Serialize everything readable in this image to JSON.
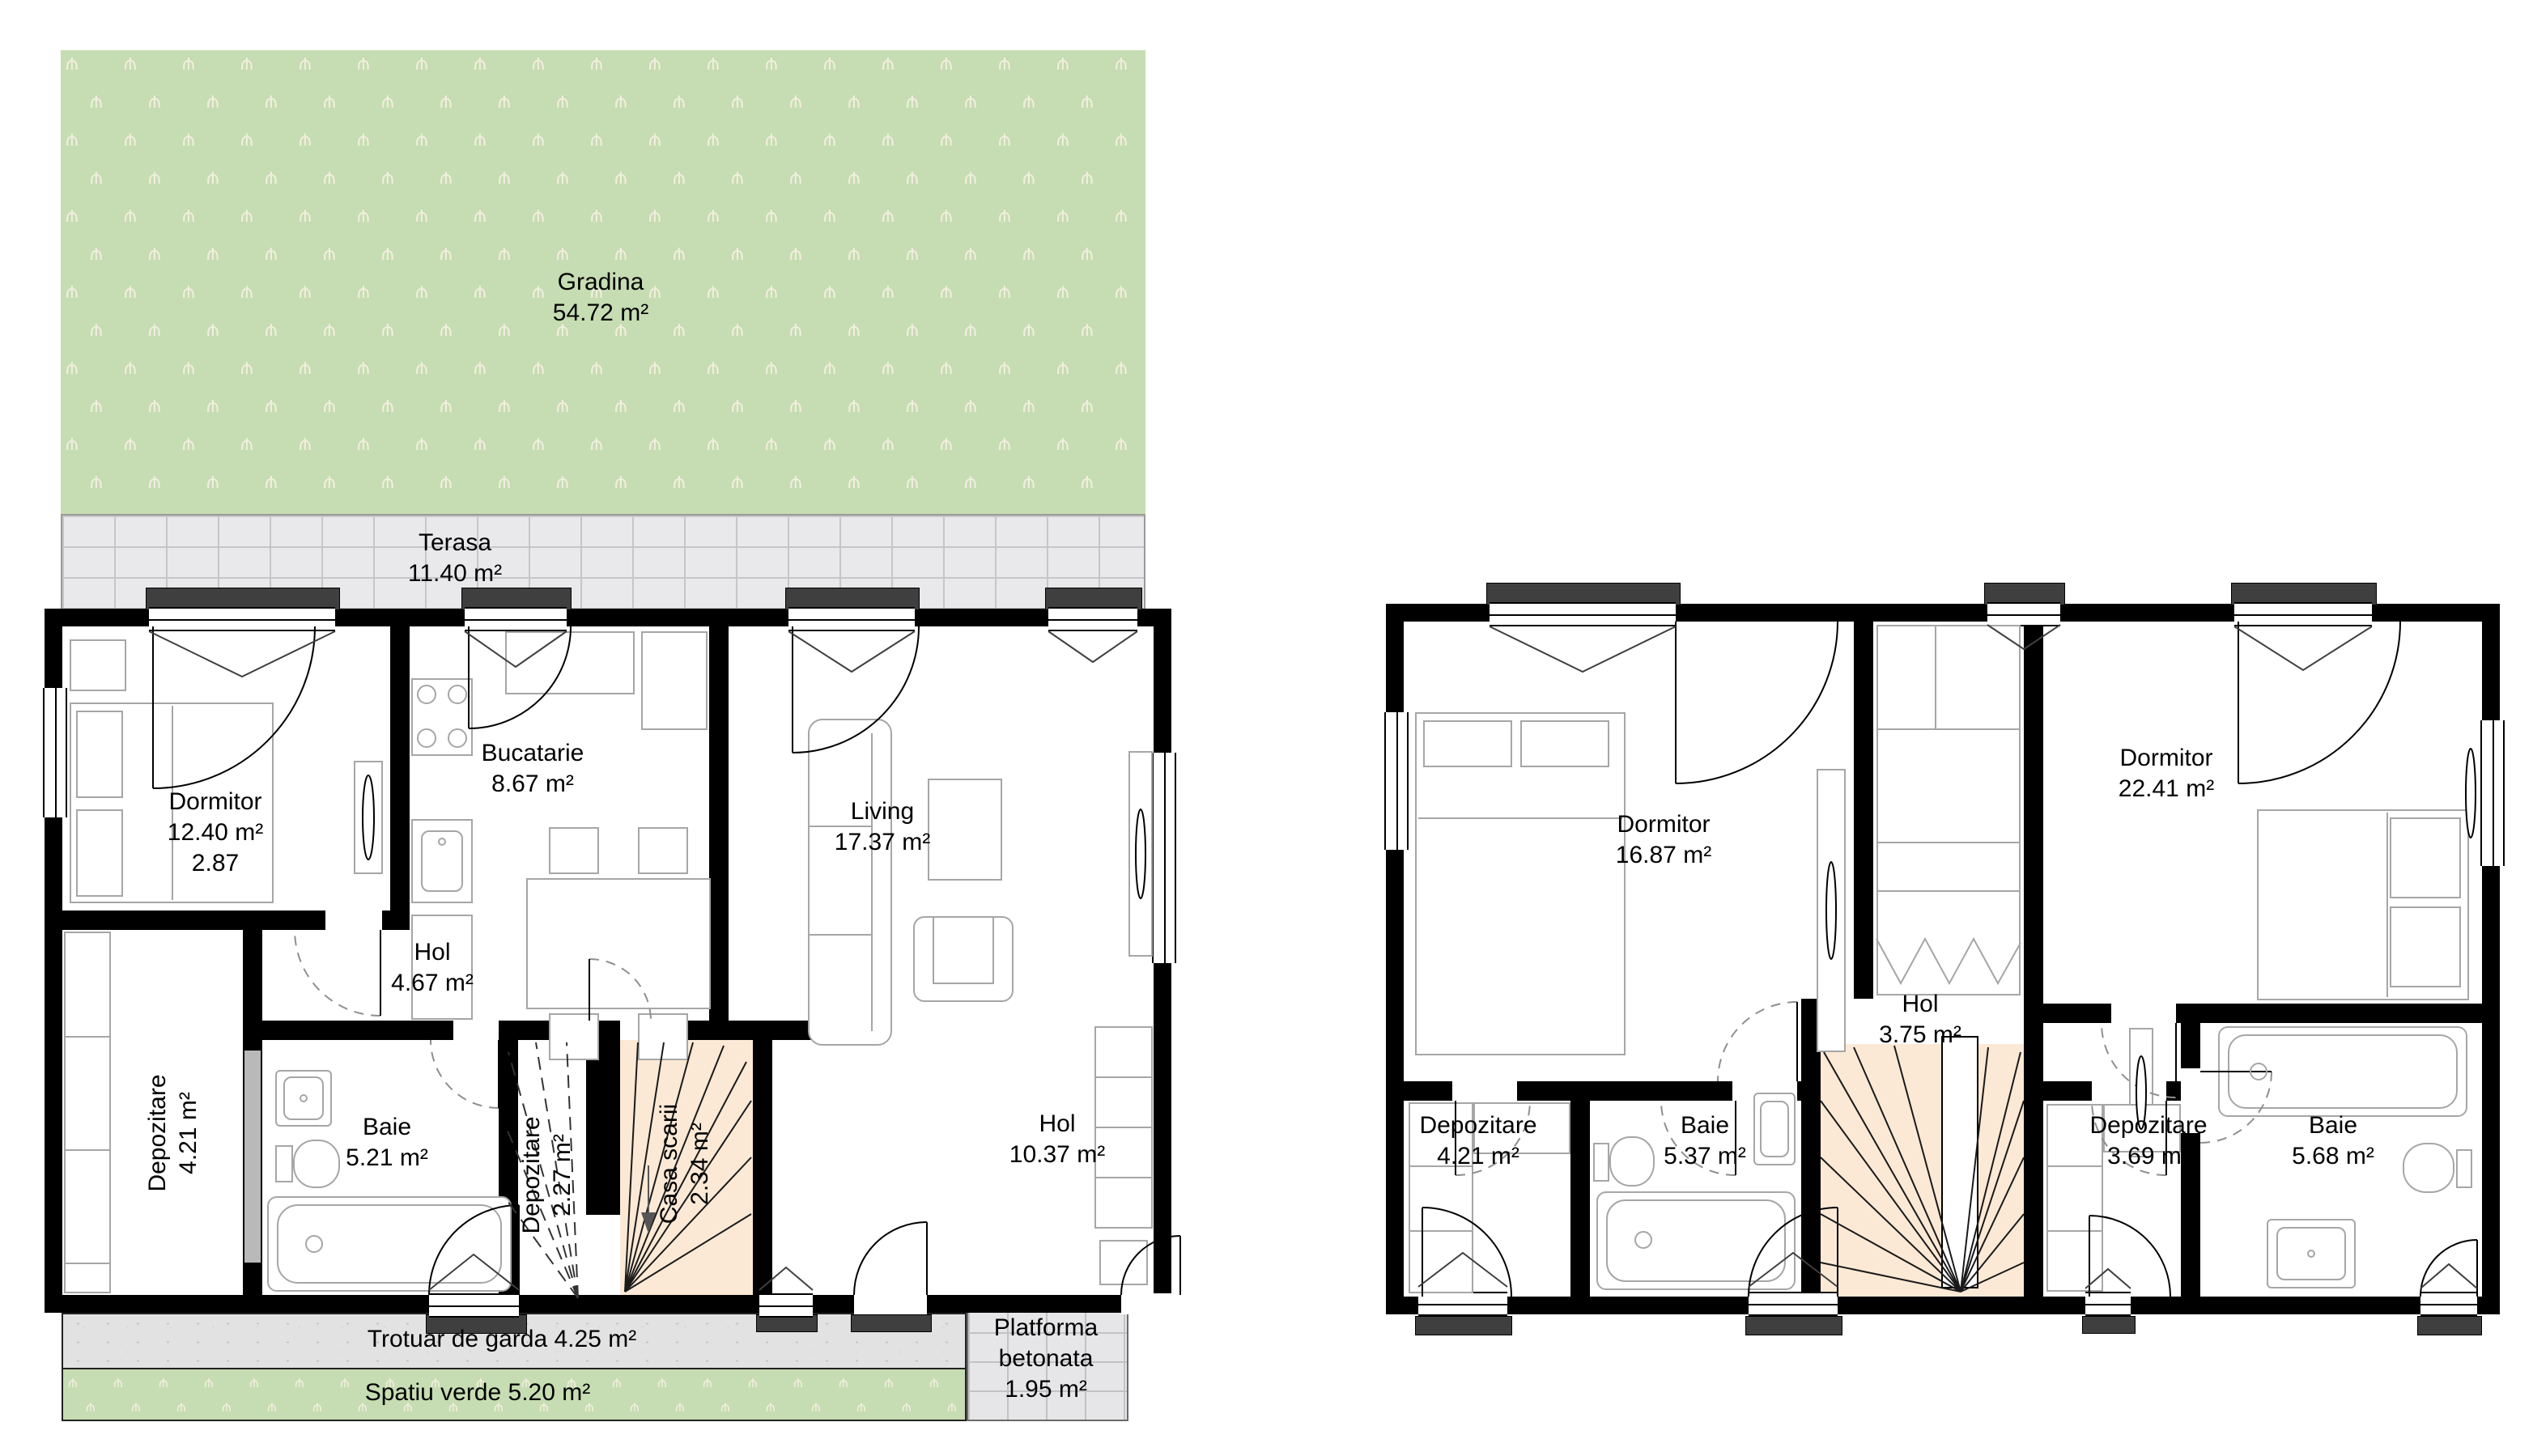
{
  "ground_floor": {
    "gradina": {
      "name": "Gradina",
      "area": "54.72 m²"
    },
    "terasa": {
      "name": "Terasa",
      "area": "11.40 m²"
    },
    "dormitor": {
      "name": "Dormitor",
      "area": "12.40 m²",
      "height": "2.87"
    },
    "bucatarie": {
      "name": "Bucatarie",
      "area": "8.67 m²"
    },
    "living": {
      "name": "Living",
      "area": "17.37 m²"
    },
    "hol": {
      "name": "Hol",
      "area": "4.67 m²"
    },
    "depozitare": {
      "name": "Depozitare",
      "area": "4.21 m²"
    },
    "baie": {
      "name": "Baie",
      "area": "5.21 m²"
    },
    "depozitare_scara": {
      "name": "Depozitare",
      "area": "2.27 m²"
    },
    "casa_scarii": {
      "name": "Casa scarii",
      "area": "2.34 m²"
    },
    "hol_parter": {
      "name": "Hol",
      "area": "10.37 m²"
    },
    "trotuar": {
      "name": "Trotuar de garda",
      "area": "4.25 m²"
    },
    "spatiu_verde": {
      "name": "Spatiu verde",
      "area": "5.20 m²"
    },
    "platforma": {
      "name": "Platforma betonata",
      "area": "1.95 m²"
    }
  },
  "upper_floor": {
    "dormitor_stanga": {
      "name": "Dormitor",
      "area": "16.87 m²"
    },
    "dormitor_dreapta": {
      "name": "Dormitor",
      "area": "22.41 m²"
    },
    "hol": {
      "name": "Hol",
      "area": "3.75 m²"
    },
    "depozitare_stanga": {
      "name": "Depozitare",
      "area": "4.21 m²"
    },
    "baie_stanga": {
      "name": "Baie",
      "area": "5.37 m²"
    },
    "depozitare_dreapta": {
      "name": "Depozitare",
      "area": "3.69 m²"
    },
    "baie_dreapta": {
      "name": "Baie",
      "area": "5.68 m²"
    }
  },
  "colors": {
    "garden": "#c6dcb2",
    "terrace": "#e9e9eb",
    "stairs": "#fbe9d6",
    "wall": "#000000",
    "furniture": "#a6a6a6",
    "lintel": "#3f3f3f"
  }
}
